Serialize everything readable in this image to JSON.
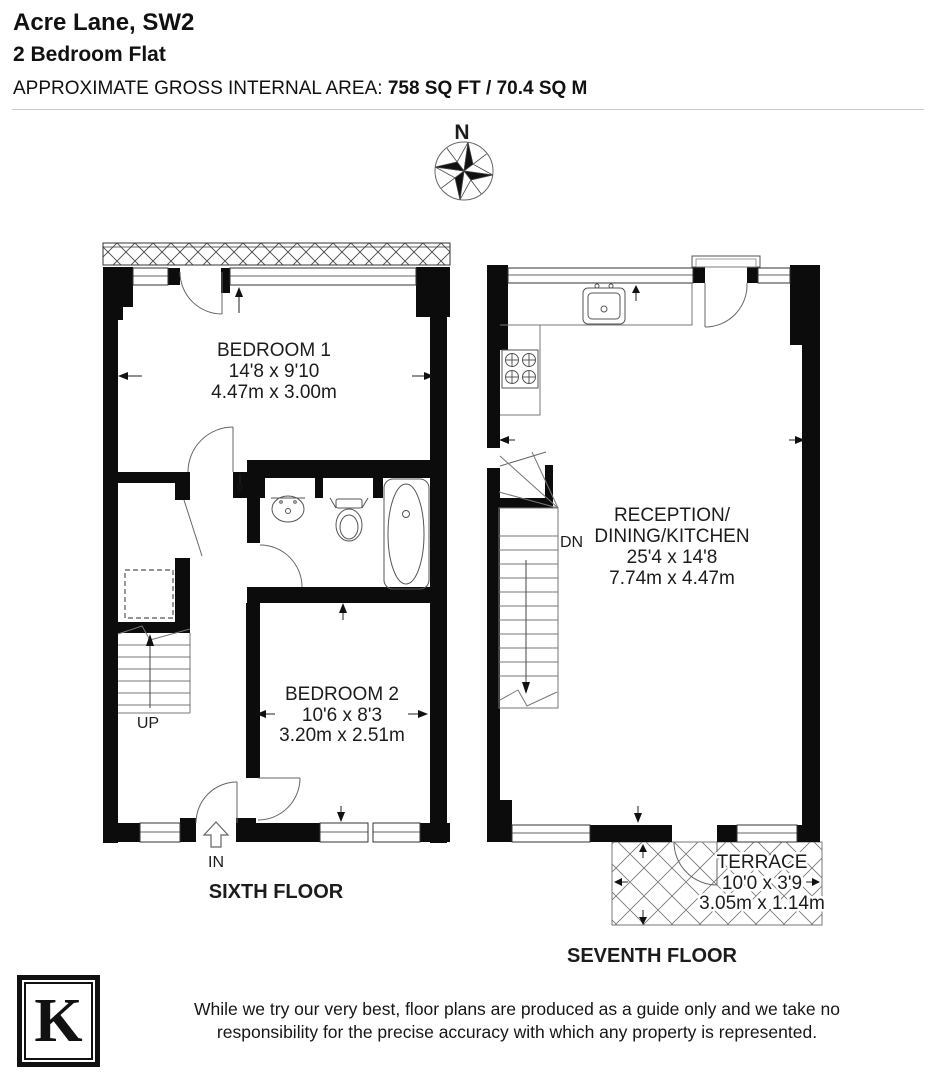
{
  "header": {
    "title": "Acre Lane, SW2",
    "subtitle": "2 Bedroom Flat",
    "area_label": "APPROXIMATE GROSS INTERNAL AREA:",
    "area_value": "758 SQ FT / 70.4 SQ M"
  },
  "compass": {
    "north_label": "N"
  },
  "floors": [
    {
      "name": "SIXTH FLOOR",
      "stair_label": "UP",
      "entrance_label": "IN",
      "rooms": [
        {
          "name": "BEDROOM 1",
          "imperial": "14'8 x 9'10",
          "metric": "4.47m x 3.00m"
        },
        {
          "name": "BEDROOM 2",
          "imperial": "10'6 x 8'3",
          "metric": "3.20m x 2.51m"
        }
      ]
    },
    {
      "name": "SEVENTH FLOOR",
      "stair_label": "DN",
      "rooms": [
        {
          "name_line1": "RECEPTION/",
          "name_line2": "DINING/KITCHEN",
          "imperial": "25'4 x 14'8",
          "metric": "7.74m x 4.47m"
        },
        {
          "name": "TERRACE",
          "imperial": "10'0 x 3'9",
          "metric": "3.05m x 1.14m"
        }
      ]
    }
  ],
  "footer": {
    "logo_letter": "K",
    "disclaimer_line1": "While we try our very best, floor plans are produced as a guide only and we take no",
    "disclaimer_line2": "responsibility for the precise accuracy with which any property is represented."
  },
  "colors": {
    "wall": "#0c0c0c",
    "background": "#ffffff",
    "line": "#555555"
  }
}
